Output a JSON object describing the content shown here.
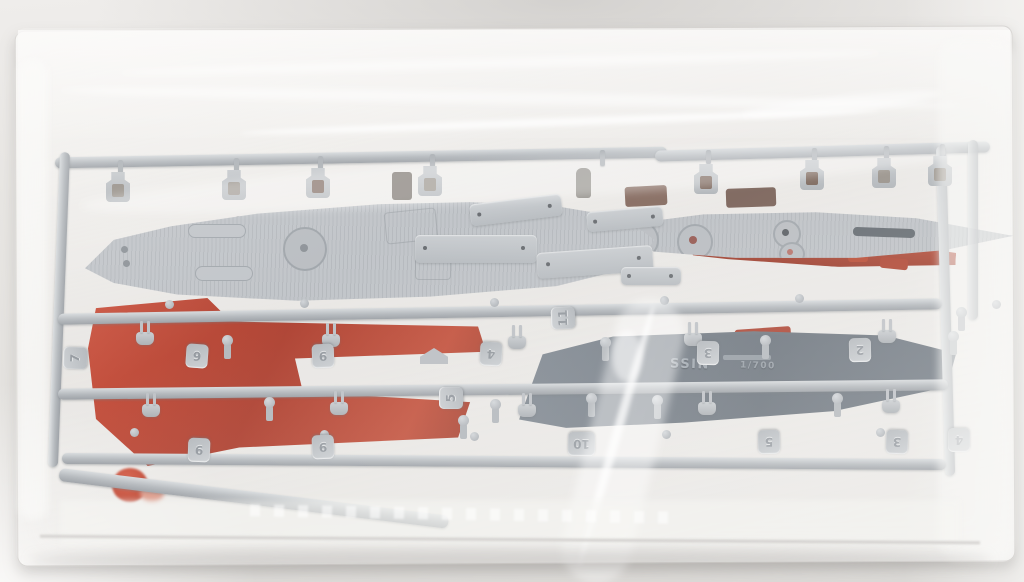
{
  "subject": "model kit sprue runners sealed in a clear plastic bag",
  "colors": {
    "backdrop": "#e8e6e3",
    "bag_film": "#f4f3f1",
    "sprue_gray": "#b7bbc0",
    "deck_gray": "#bcc0c5",
    "dark_hull_gray": "#666f79",
    "hull_red": "#b52c1a",
    "dark_red": "#8a3422",
    "maroon_brown": "#775a4e"
  },
  "part_tags": [
    {
      "label": "7"
    },
    {
      "label": "6"
    },
    {
      "label": "9"
    },
    {
      "label": "4"
    },
    {
      "label": "11"
    },
    {
      "label": "3"
    },
    {
      "label": "2"
    },
    {
      "label": "5"
    },
    {
      "label": "9"
    },
    {
      "label": "9"
    },
    {
      "label": "10"
    },
    {
      "label": "5"
    },
    {
      "label": "3"
    },
    {
      "label": "4"
    }
  ],
  "hull_markings": {
    "name_fragment": "SSIN",
    "scale_fragment": "1/700"
  }
}
